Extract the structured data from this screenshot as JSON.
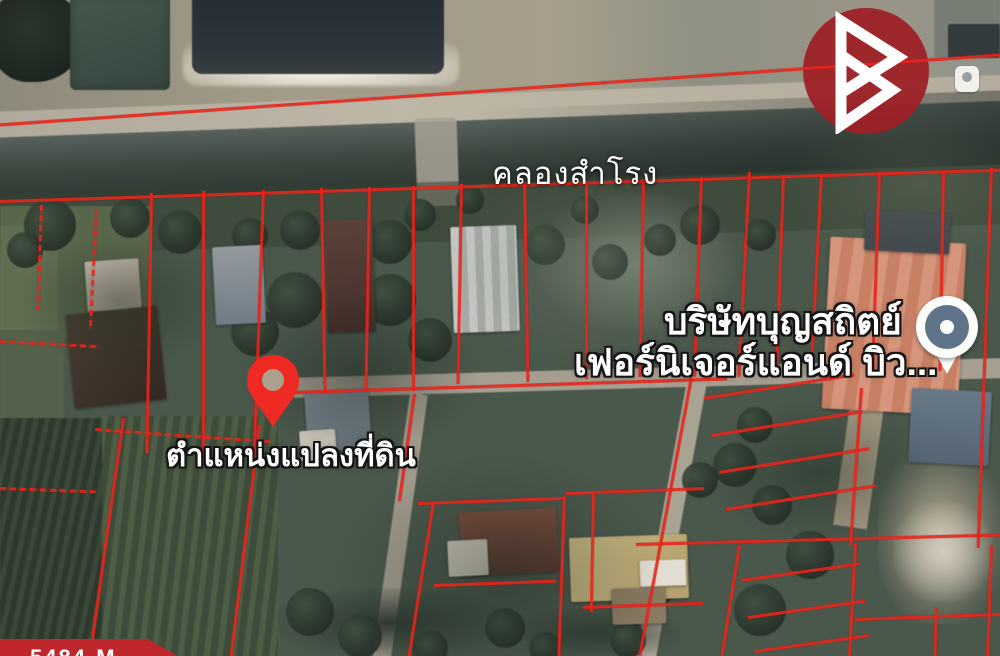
{
  "meta": {
    "view": "satellite-map-with-parcel-overlay"
  },
  "colors": {
    "boundary_red": "#e8251c",
    "pin_red": "#ee2a23",
    "logo_red": "#9e2127",
    "banner_red": "#c0272d",
    "poi_blue": "#5f7488",
    "label_white": "#ffffff"
  },
  "labels": {
    "canal_name": "คลองสำโรง",
    "company_line1": "บริษัทบุญสถิตย์",
    "company_line2": "เฟอร์นิเจอร์แอนด์ บิว...",
    "pin_caption": "ตำแหน่งแปลงที่ดิน",
    "banner_id": "5484-M"
  },
  "icons": {
    "land_pin": "red-location-pin",
    "business_poi": "map-poi-balloon",
    "brand": "triangle-b-logo"
  }
}
